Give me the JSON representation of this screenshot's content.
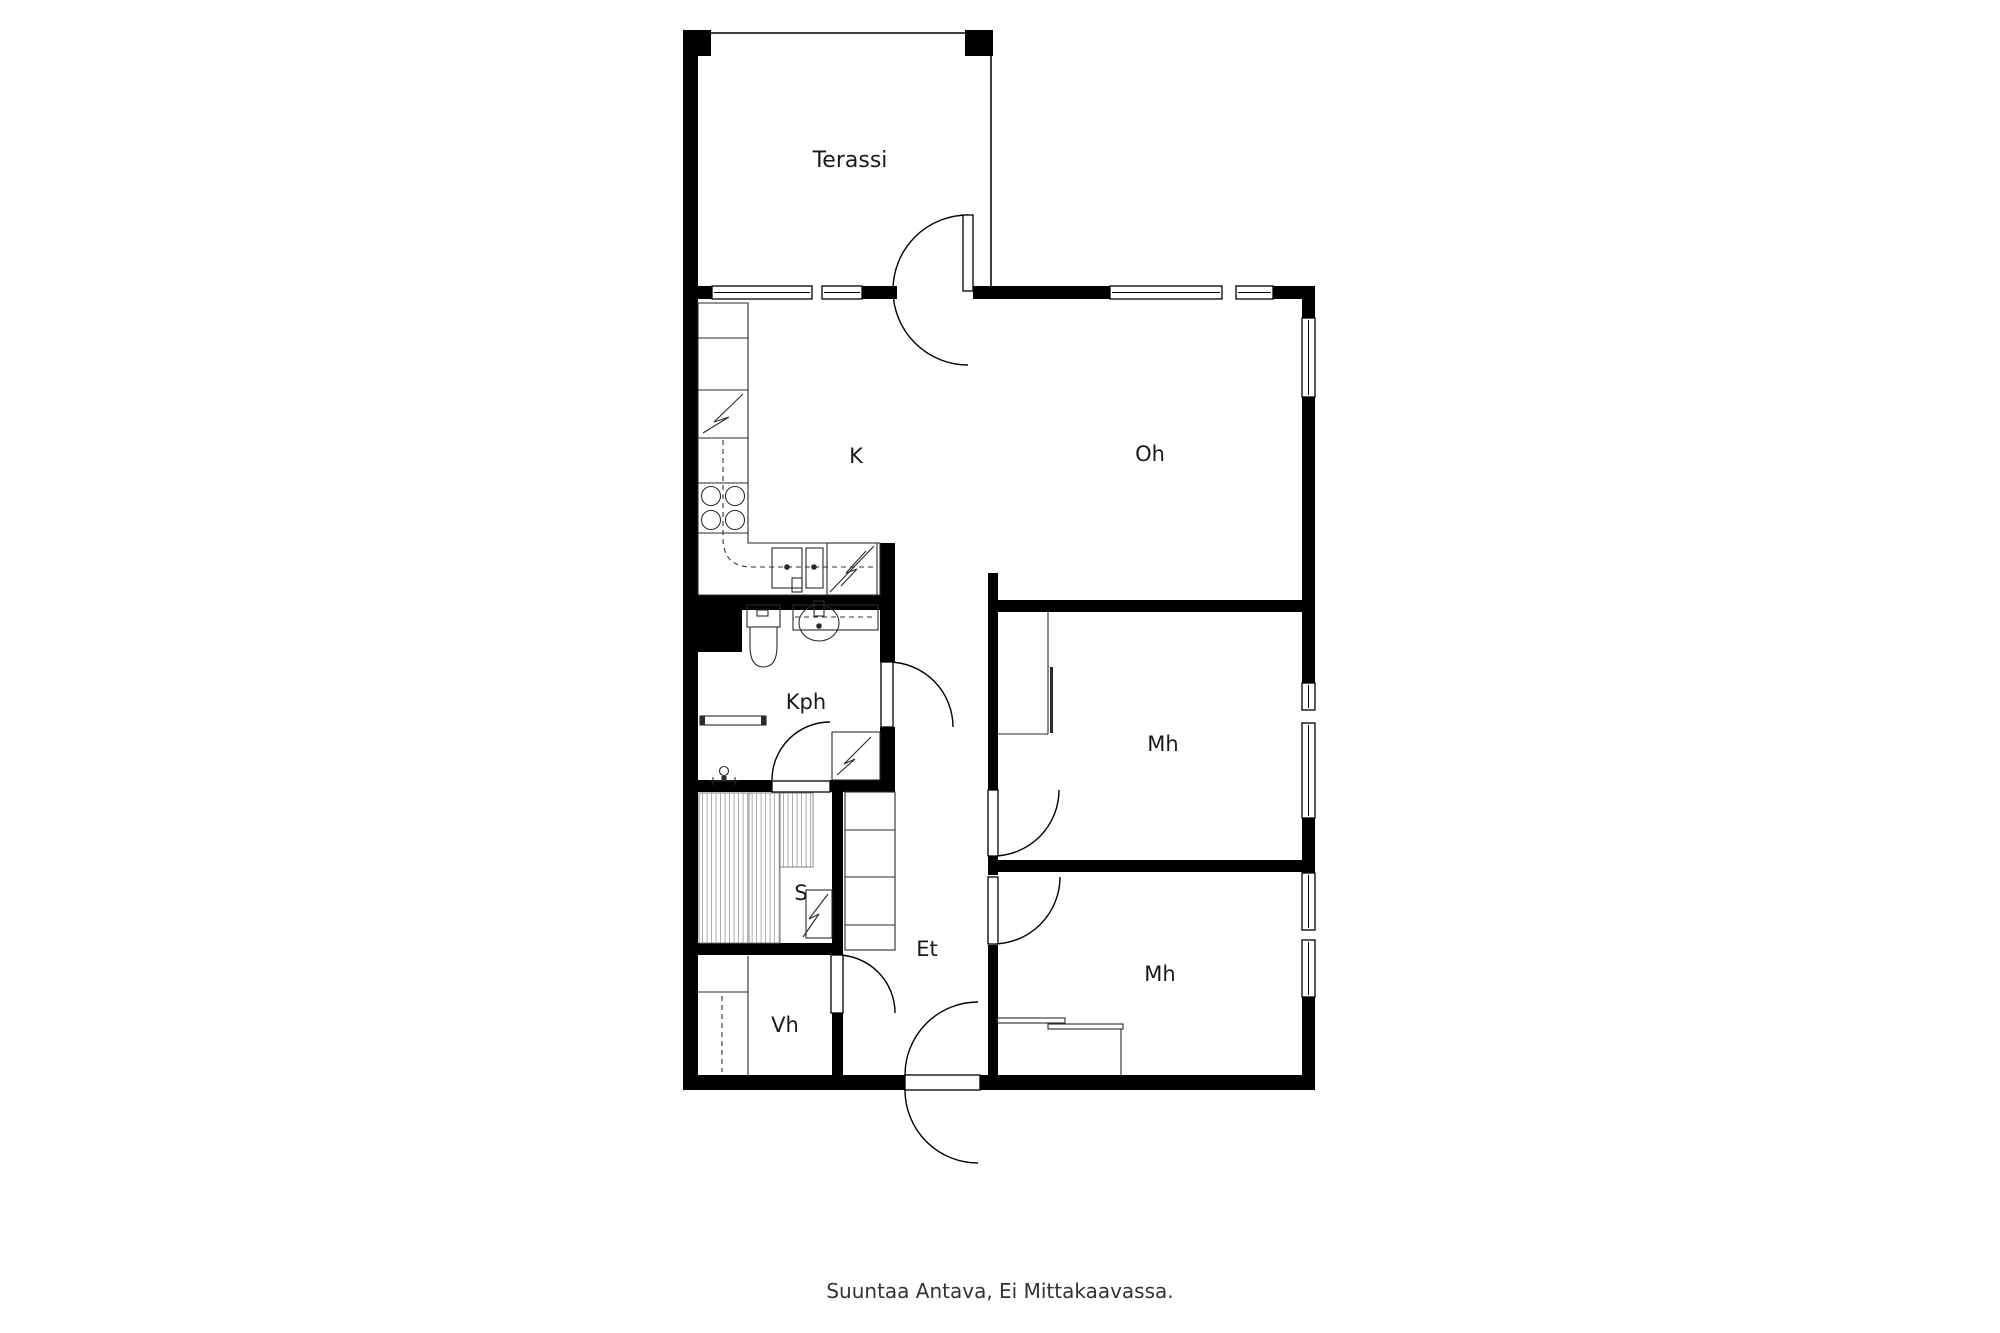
{
  "floorplan": {
    "rooms": {
      "terrace": {
        "label": "Terassi"
      },
      "kitchen": {
        "label": "K"
      },
      "living_room": {
        "label": "Oh"
      },
      "bathroom": {
        "label": "Kph"
      },
      "sauna": {
        "label": "S"
      },
      "entry": {
        "label": "Et"
      },
      "closet": {
        "label": "Vh"
      },
      "bedroom_1": {
        "label": "Mh"
      },
      "bedroom_2": {
        "label": "Mh"
      }
    },
    "caption": "Suuntaa Antava, Ei Mittakaavassa.",
    "colors": {
      "wall": "#000000",
      "background": "#ffffff",
      "hatch": "#8a8a8a",
      "text": "#1a1a1a"
    }
  }
}
